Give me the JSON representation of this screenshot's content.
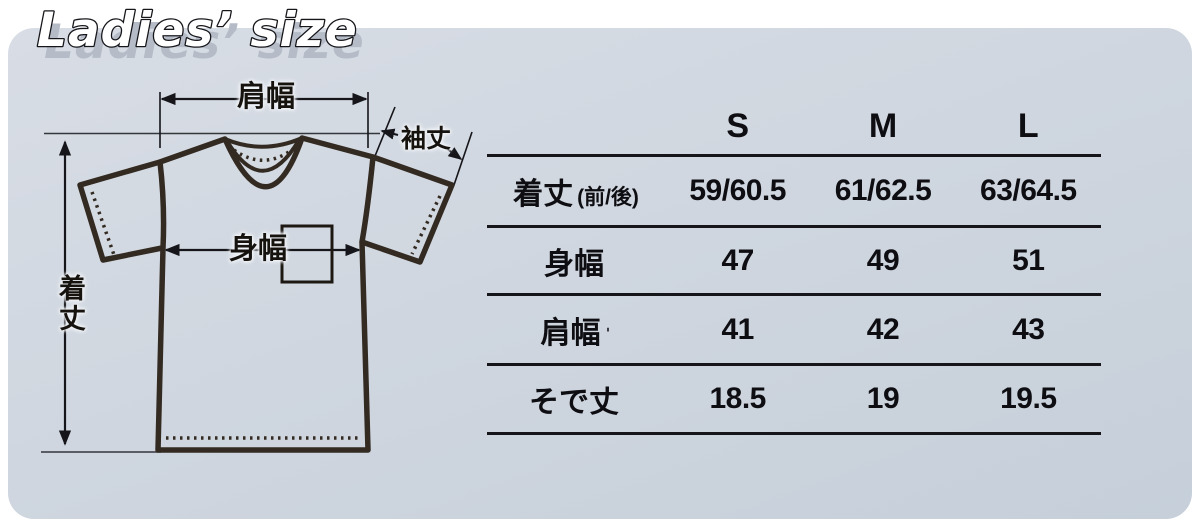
{
  "title": {
    "text": "Ladies’ size"
  },
  "colors": {
    "panel": "#cfd6df",
    "title_shadow": "#b5bcc7",
    "shirt_line": "#332a22",
    "table_line": "#15151a"
  },
  "diagram": {
    "shoulder_width_label": "肩幅",
    "sleeve_length_label": "袖丈",
    "body_width_label": "身幅",
    "body_length_label": "着丈"
  },
  "table": {
    "columns": [
      "S",
      "M",
      "L"
    ],
    "rows": [
      {
        "label": "着丈",
        "note": "(前/後)",
        "values": [
          "59/60.5",
          "61/62.5",
          "63/64.5"
        ]
      },
      {
        "label": "身幅",
        "note": "",
        "values": [
          "47",
          "49",
          "51"
        ]
      },
      {
        "label": "肩幅",
        "note": "ˈ",
        "values": [
          "41",
          "42",
          "43"
        ]
      },
      {
        "label": "そで丈",
        "note": "",
        "values": [
          "18.5",
          "19",
          "19.5"
        ]
      }
    ]
  }
}
